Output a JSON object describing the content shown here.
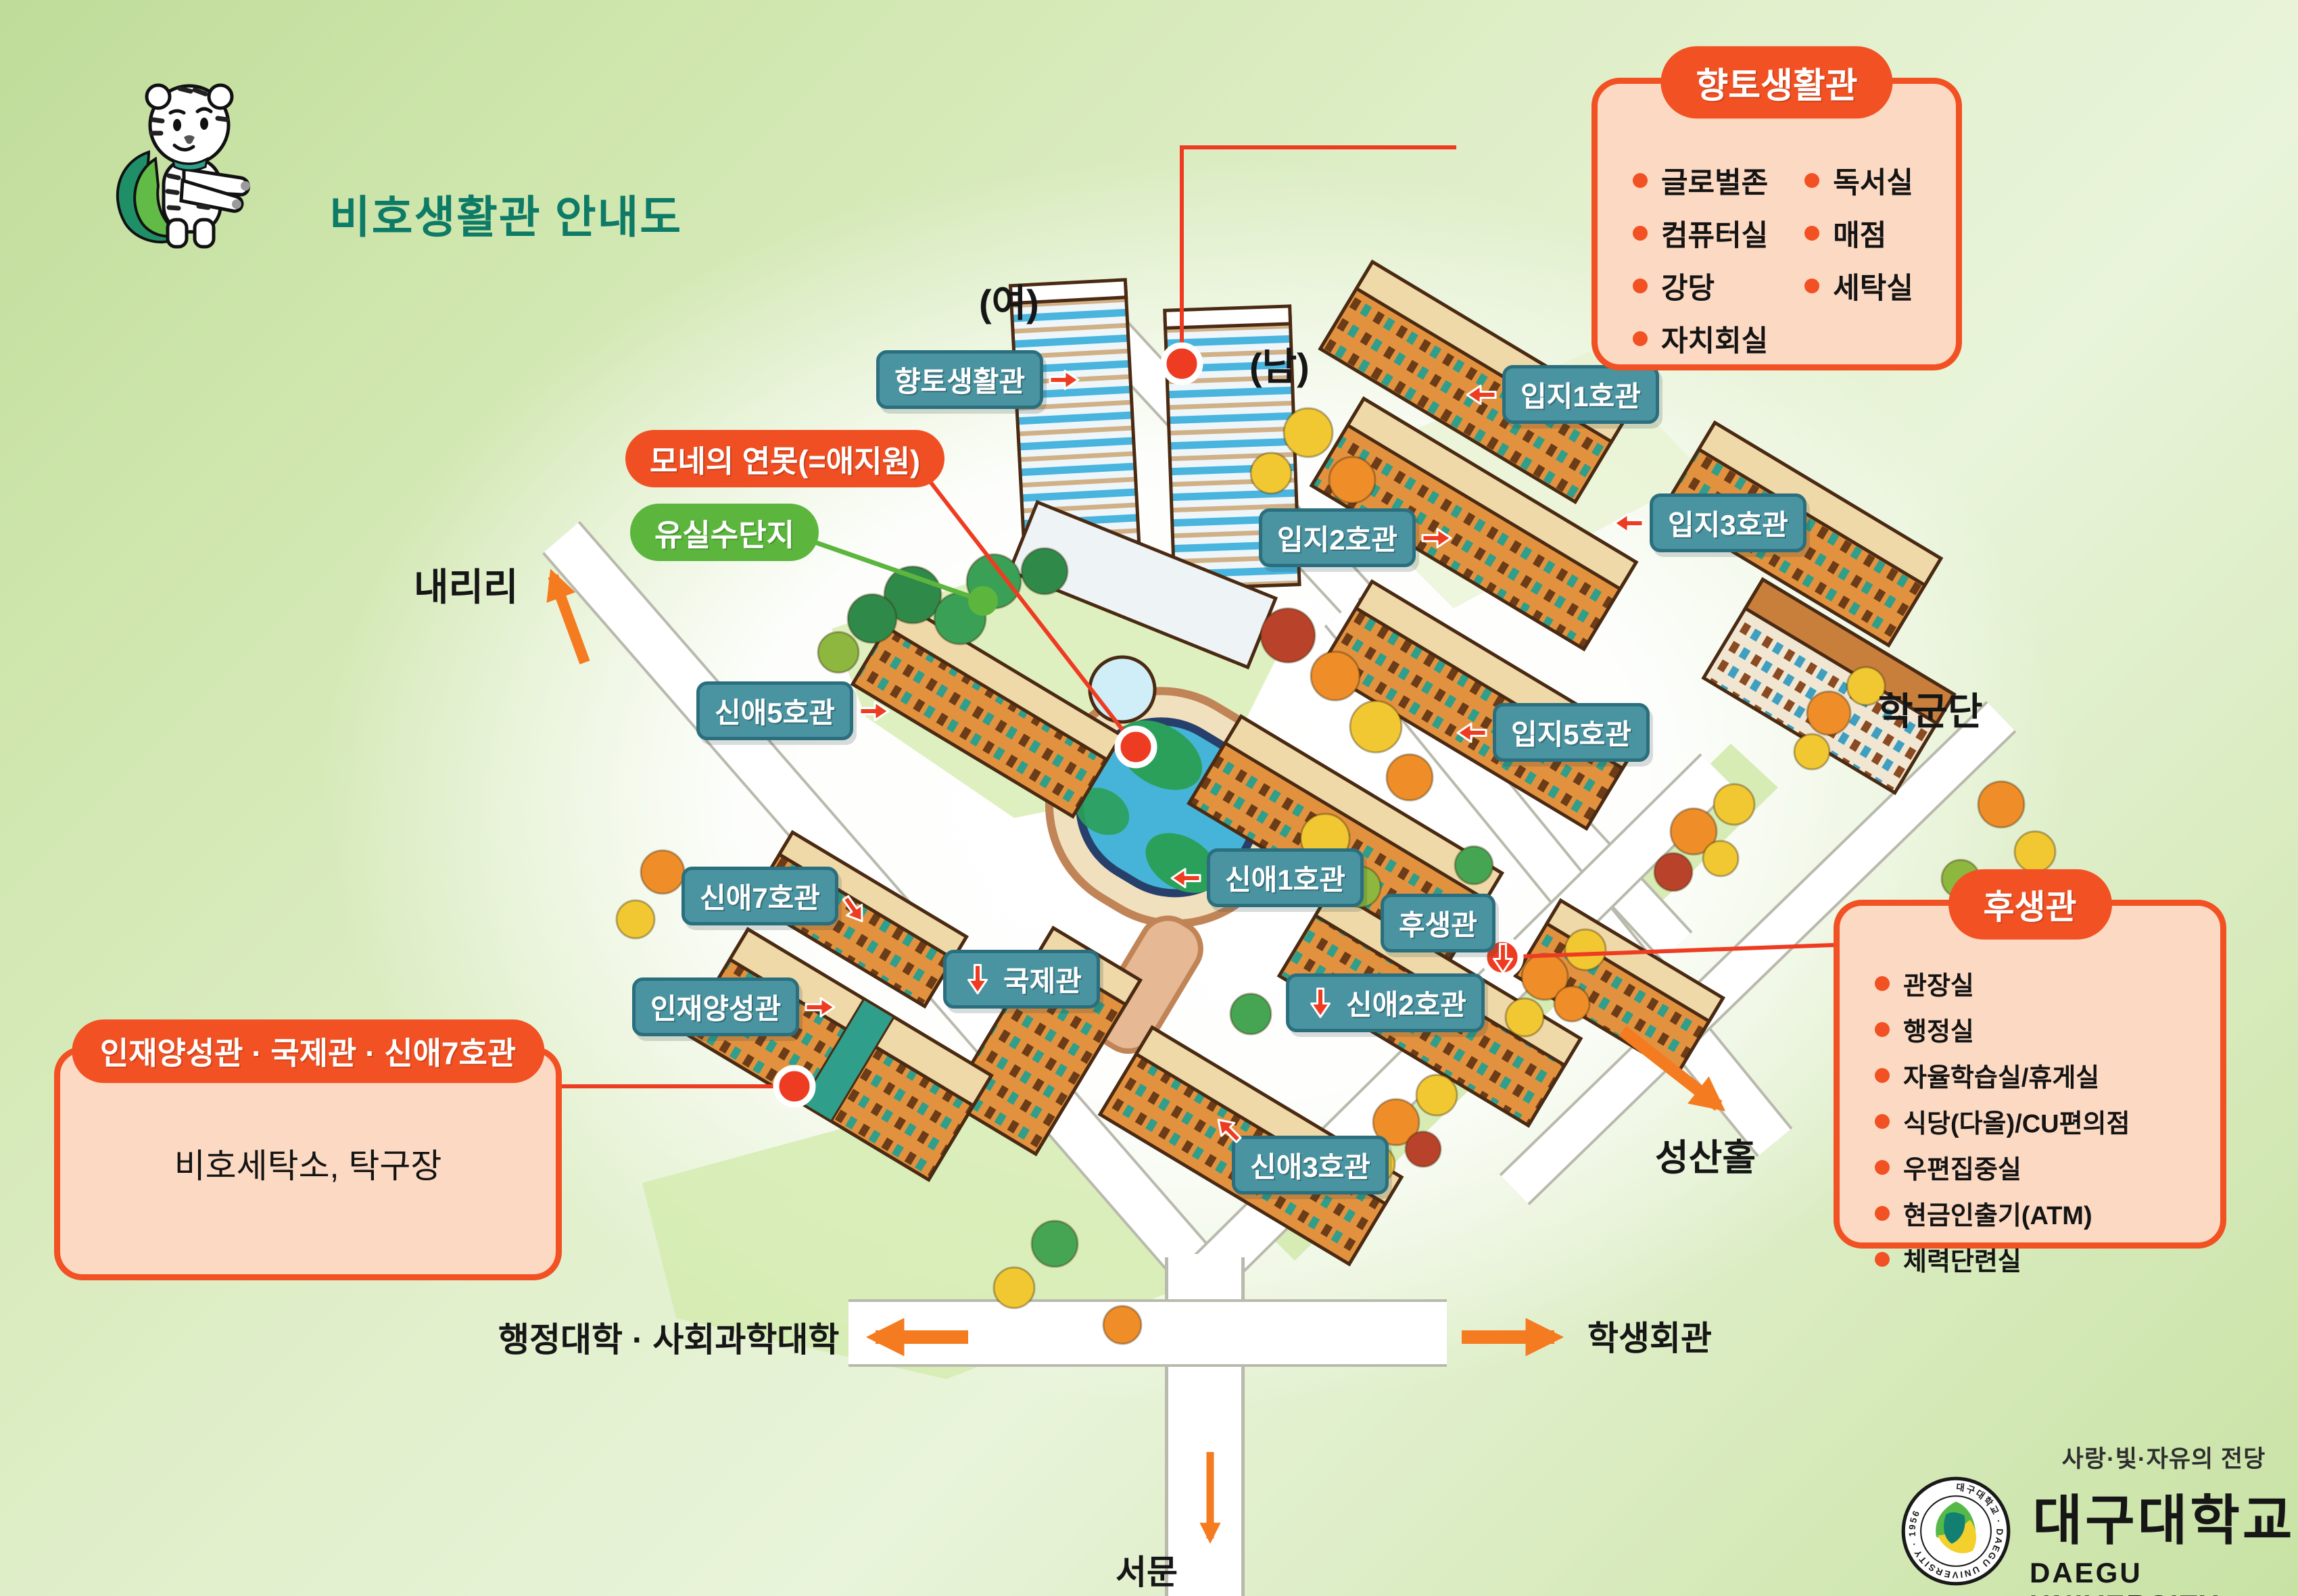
{
  "title": "비호생활관 안내도",
  "building_labels": {
    "hyangto": "향토생활관",
    "ipji1": "입지1호관",
    "ipji2": "입지2호관",
    "ipji3": "입지3호관",
    "ipji5": "입지5호관",
    "sinae5": "신애5호관",
    "sinae1": "신애1호관",
    "husaeng": "후생관",
    "sinae7": "신애7호관",
    "gukje": "국제관",
    "injae": "인재양성관",
    "sinae2": "신애2호관",
    "sinae3": "신애3호관"
  },
  "poi_labels": {
    "monet_pond": "모네의 연못(=애지원)",
    "orchard": "유실수단지"
  },
  "area_labels": {
    "female_dorm": "(여)",
    "male_dorm": "(남)",
    "hakgundan": "학군단",
    "naeriri": "내리리",
    "seongsan_hall": "성산홀",
    "west_gate": "서문",
    "admin_social_college": "행정대학 · 사회과학대학",
    "student_hall": "학생회관"
  },
  "callouts": {
    "hyangto": {
      "title": "향토생활관",
      "items_left": [
        "글로벌존",
        "컴퓨터실",
        "강당",
        "자치회실"
      ],
      "items_right": [
        "독서실",
        "매점",
        "세탁실"
      ]
    },
    "husaeng": {
      "title": "후생관",
      "items": [
        "관장실",
        "행정실",
        "자율학습실/휴게실",
        "식당(다올)/CU편의점",
        "우편집중실",
        "현금인출기(ATM)",
        "체력단련실"
      ]
    },
    "injae": {
      "title": "인재양성관 · 국제관 · 신애7호관",
      "body": "비호세탁소, 탁구장"
    }
  },
  "logo": {
    "slogan": "사랑·빛·자유의 전당",
    "university_ko": "대구대학교",
    "university_en": "DAEGU UNIVERSITY",
    "seal_text": "대구대학교 · DAEGU UNIVERSITY · 1956"
  },
  "colors": {
    "accent_orange": "#f15123",
    "label_teal": "#4a93a0",
    "pill_green": "#5cb63e",
    "road_arrow_orange": "#f47b20",
    "title_green": "#0d7b66"
  }
}
